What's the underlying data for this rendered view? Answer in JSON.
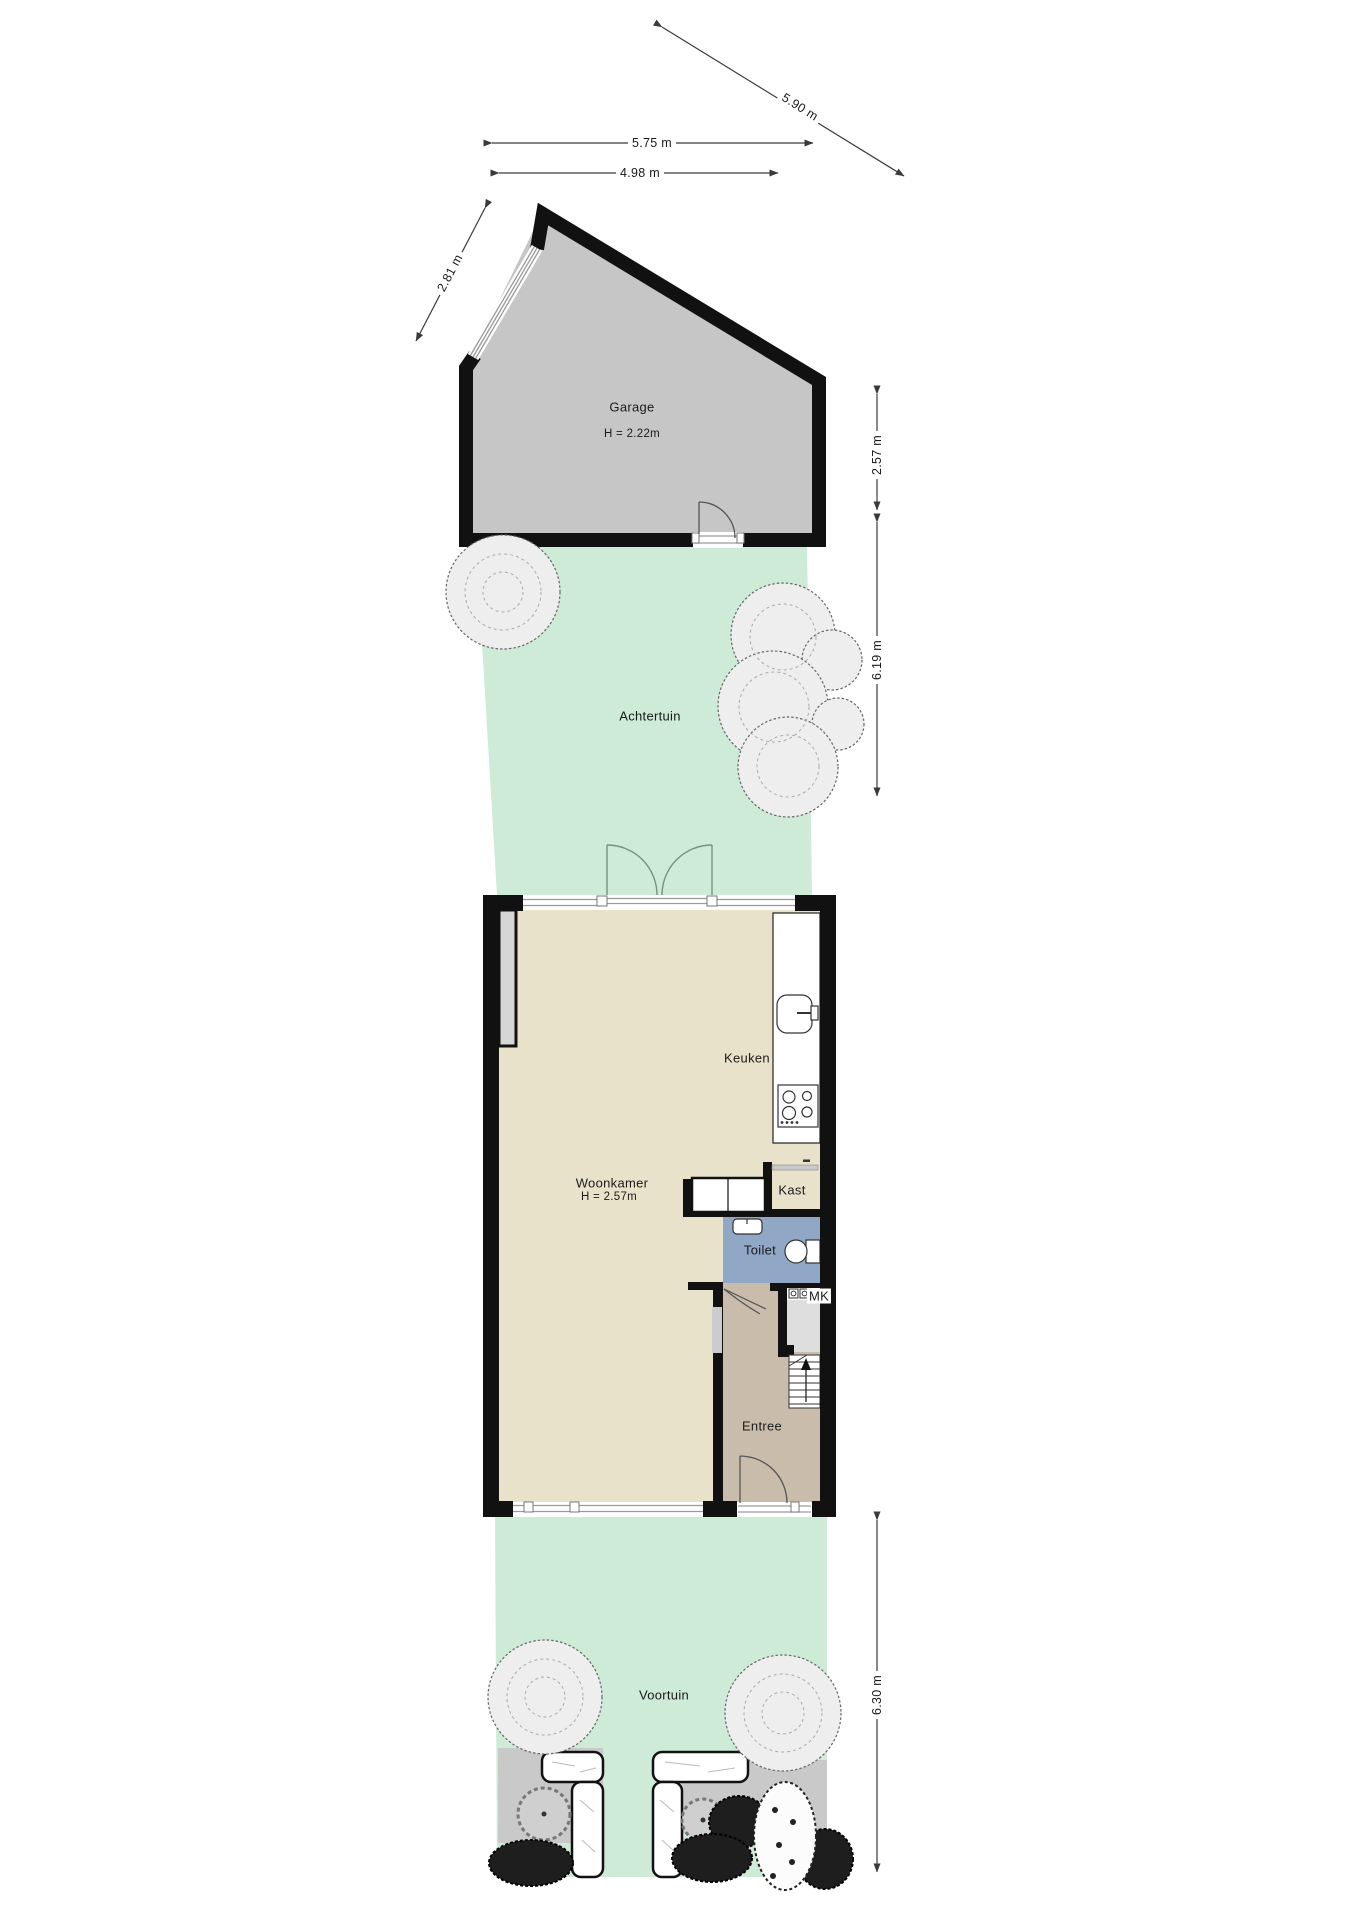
{
  "plan_title": "Begane grond met tuin (floor plan)",
  "rooms": {
    "garage": {
      "label": "Garage",
      "height_note": "H = 2.22m"
    },
    "achtertuin": {
      "label": "Achtertuin"
    },
    "woonkamer": {
      "label": "Woonkamer",
      "height_note": "H = 2.57m"
    },
    "keuken": {
      "label": "Keuken"
    },
    "kast": {
      "label": "Kast"
    },
    "toilet": {
      "label": "Toilet"
    },
    "mk": {
      "label": "MK"
    },
    "entree": {
      "label": "Entree"
    },
    "voortuin": {
      "label": "Voortuin"
    }
  },
  "dimensions": {
    "top_width": "5.75 m",
    "garage_width": "4.98 m",
    "diagonal_side": "5.90 m",
    "garage_left_side": "2.81 m",
    "garage_depth": "2.57 m",
    "achtertuin_depth": "6.19 m",
    "voortuin_depth": "6.30 m"
  },
  "colors": {
    "garden_green": "#cdebd6",
    "garage_gray": "#c6c6c6",
    "paving_gray": "#c9c9c9",
    "floor_beige": "#e9e2cb",
    "entree_taupe": "#c9bcab",
    "toilet_blue": "#90a8c6",
    "mk_gray": "#dedede",
    "wall_black": "#111111",
    "dim_line": "#3a3a3a"
  }
}
